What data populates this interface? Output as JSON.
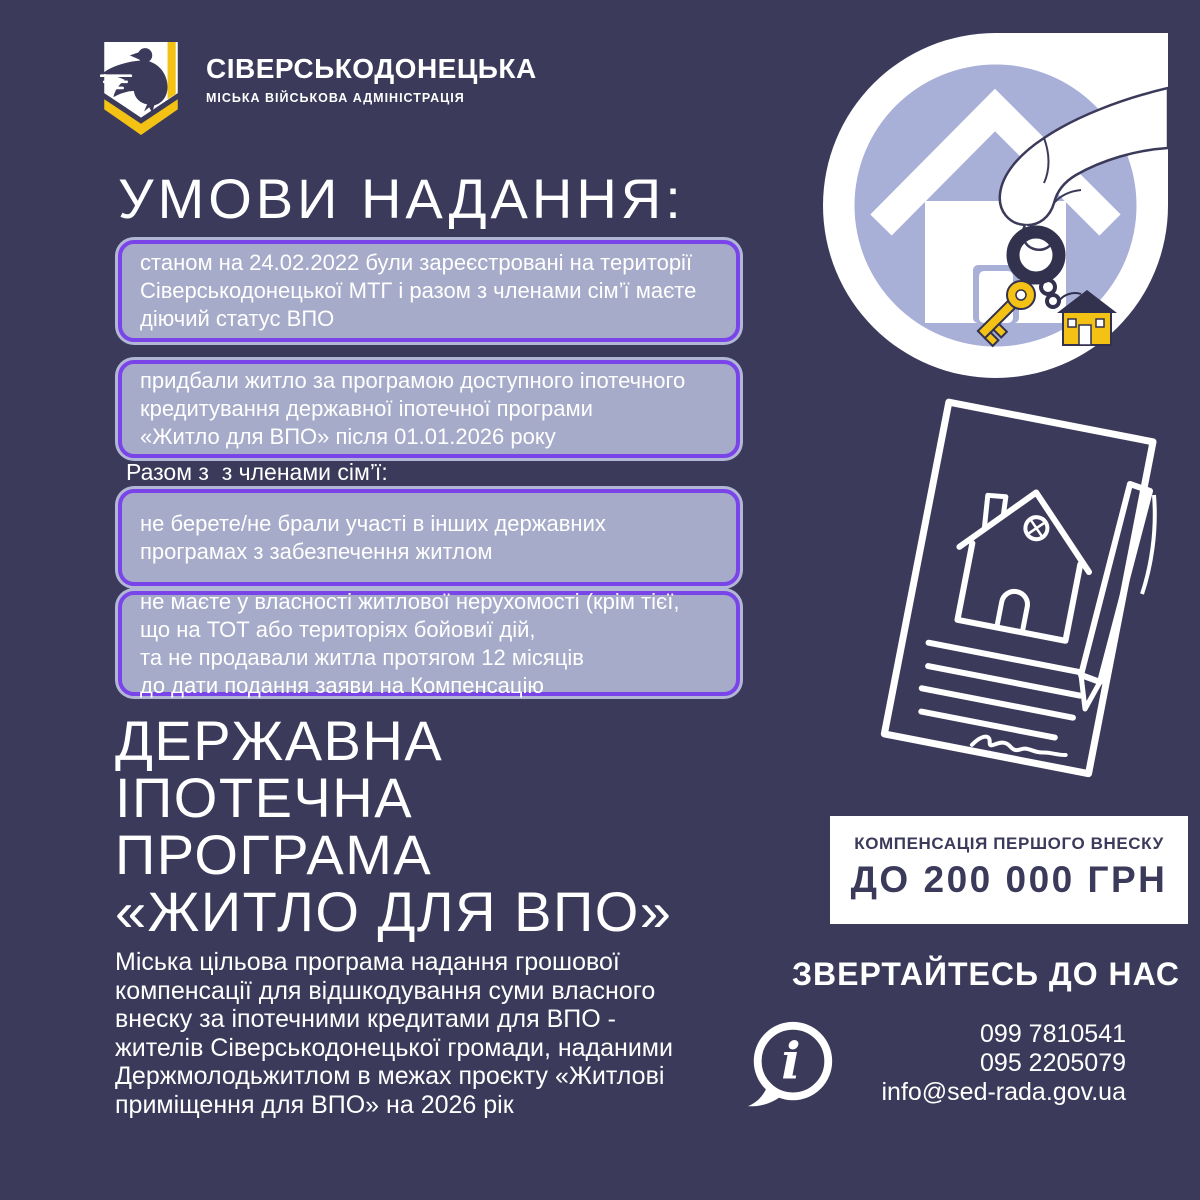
{
  "colors": {
    "background": "#3b3a5a",
    "box_fill": "#a6abc9",
    "box_border_purple": "#7a45e8",
    "box_outer_ring": "#b2b7d6",
    "accent_yellow": "#f3c215",
    "illustration_lavender": "#a9b0d8",
    "white": "#ffffff",
    "navy_text": "#3b3a5a"
  },
  "icons": {
    "logo_icon": "shield-with-pigeon",
    "house_keys_illustration": "hand-holding-keys-over-house-in-circle",
    "contract_illustration": "sketched-contract-with-house-and-pen",
    "info_icon": "speech-bubble-with-italic-i"
  },
  "header": {
    "org_name": "СІВЕРСЬКОДОНЕЦЬКА",
    "org_subtitle": "МІСЬКА ВІЙСЬКОВА АДМІНІСТРАЦІЯ"
  },
  "conditions": {
    "title": "УМОВИ НАДАННЯ:",
    "items": [
      "станом на 24.02.2022 були зареєстровані на території\nСіверськодонецької МТГ і разом з членами сім’ї маєте\nдіючий статус ВПО",
      "придбали житло за програмою доступного іпотечного\nкредитування державної іпотечної програми\n«Житло для ВПО» після 01.01.2026 року",
      "не берете/не брали участі в інших державних\nпрограмах з забезпечення житлом",
      "не маєте у власності житлової нерухомості (крім тієї,\nщо на ТОТ або територіях бойовиї дій,\nта не продавали житла протягом 12 місяців\nдо дати подання заяви на Компенсацію"
    ],
    "family_note": "Разом з  з членами сім’ї:"
  },
  "program": {
    "title_lines": [
      "ДЕРЖАВНА",
      "ІПОТЕЧНА",
      "ПРОГРАМА",
      "«ЖИТЛО ДЛЯ ВПО»"
    ],
    "description": "Міська цільова програма надання грошової\nкомпенсації для відшкодування суми власного\nвнеску за іпотечними кредитами для ВПО -\nжителів Сіверськодонецької громади, наданими\nДержмолодьжитлом в межах проєкту «Житлові\nприміщення для ВПО» на 2026 рік"
  },
  "compensation": {
    "label": "КОМПЕНСАЦІЯ ПЕРШОГО ВНЕСКУ",
    "amount": "ДО 200 000 ГРН"
  },
  "contact": {
    "title": "ЗВЕРТАЙТЕСЬ ДО НАС",
    "phone1": "099 7810541",
    "phone2": "095 2205079",
    "email": "info@sed-rada.gov.ua"
  }
}
